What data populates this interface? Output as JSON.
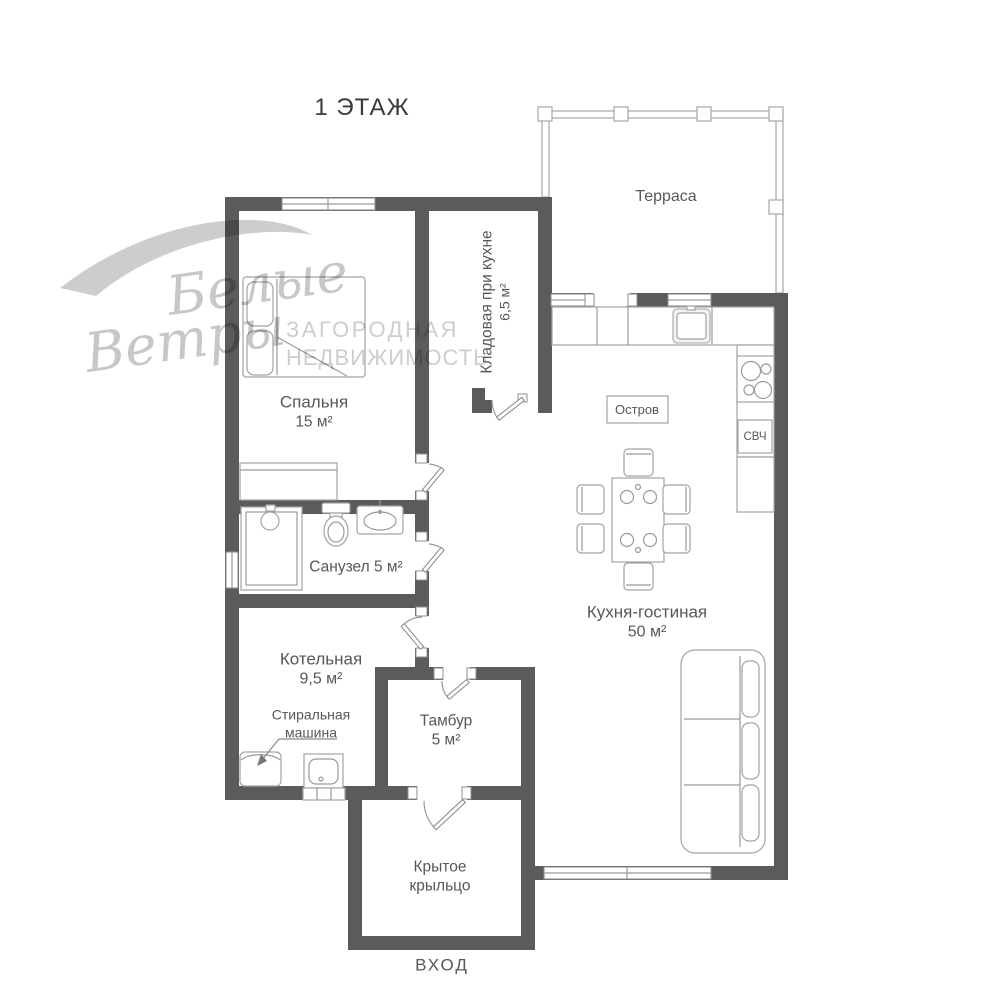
{
  "title": "1 ЭТАЖ",
  "watermark": {
    "script_line1": "Белые",
    "script_line2": "Ветры",
    "caps_line1": "ЗАГОРОДНАЯ",
    "caps_line2": "НЕДВИЖИМОСТЬ"
  },
  "rooms": {
    "terrace": {
      "name": "Терраса"
    },
    "bedroom": {
      "name": "Спальня",
      "area": "15 м²"
    },
    "pantry": {
      "name": "Кладовая при кухне",
      "area": "6,5 м²"
    },
    "bathroom": {
      "name": "Санузел 5 м²"
    },
    "kitchen_living": {
      "name": "Кухня-гостиная",
      "area": "50 м²"
    },
    "boiler": {
      "name": "Котельная",
      "area": "9,5 м²"
    },
    "vestibule": {
      "name": "Тамбур",
      "area": "5 м²"
    },
    "porch": {
      "name_line1": "Крытое",
      "name_line2": "крыльцо"
    }
  },
  "annotations": {
    "island": "Остров",
    "microwave": "СВЧ",
    "washer_line1": "Стиральная",
    "washer_line2": "машина",
    "entrance": "ВХОД"
  },
  "colors": {
    "wall": "#5b5b5b",
    "label_text": "#57575a",
    "outline": "#9a9a9a",
    "watermark": "#a0a0a0"
  }
}
